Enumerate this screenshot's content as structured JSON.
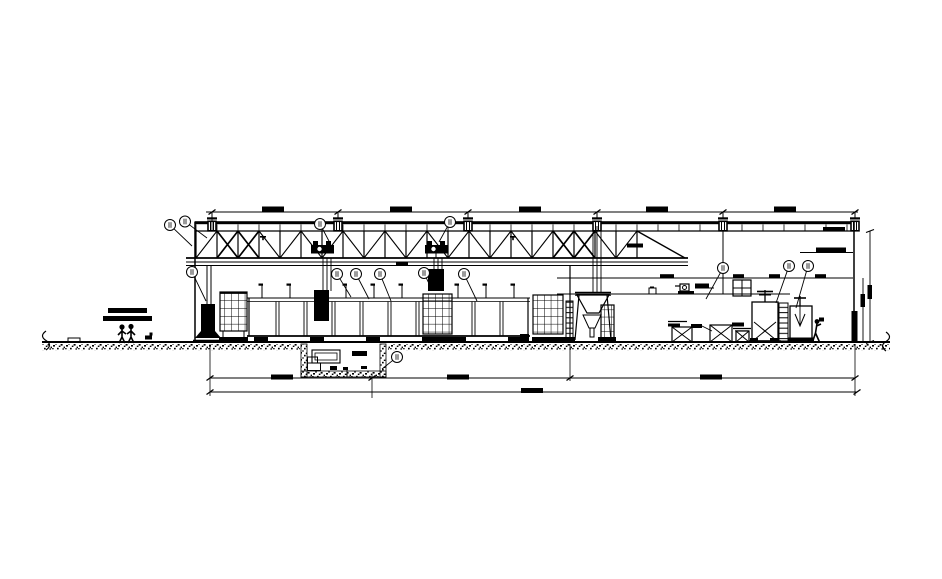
{
  "canvas": {
    "width": 942,
    "height": 579,
    "background": "#ffffff"
  },
  "drawing": {
    "description": "Black and white CAD section elevation of an industrial hall: suspended roof truss with hanger posts, hoist trolleys, process basin with grating panels, storage tank, furnace hopper with ladder, pump platform, crates, two agitated mixing tanks, workers, an underground pit and horizontal dimension chains",
    "ink": "#000000",
    "paper": "#ffffff",
    "callout_fill": "#ffffff",
    "callout_smudge": "#9a9a9a",
    "title": ""
  },
  "dimensions": {
    "top_chain": {
      "segments": 5,
      "texts": [
        "",
        "",
        "",
        "",
        ""
      ],
      "illegible": true
    },
    "bottom_chain_1": {
      "segments": 3,
      "texts": [
        "",
        "",
        ""
      ],
      "illegible": true
    },
    "bottom_chain_2": {
      "segments": 1,
      "texts": [
        ""
      ],
      "illegible": true
    },
    "right_vertical_chain": {
      "segments": 2,
      "texts": [
        "",
        ""
      ],
      "illegible": true
    },
    "interior_labels": {
      "count": 10,
      "texts_illegible": true
    }
  },
  "callouts": {
    "count": 14,
    "labels_illegible": true,
    "label_text": ""
  },
  "components": [
    "dimension-line-top",
    "roof-beam",
    "truss-top-chord",
    "roof-hangers",
    "roof-truss",
    "hoist-trolley-1",
    "hoist-trolley-2",
    "suspended-load",
    "left-wall",
    "right-wall",
    "storage-tank",
    "grating-panel-1",
    "process-basin",
    "grating-panel-2",
    "grating-panel-3",
    "furnace-hopper",
    "access-ladder",
    "annex-platform-lines",
    "pump-unit",
    "window-grid",
    "crate-1",
    "crate-2",
    "drum-crate",
    "mixing-tank-1",
    "tank-ladder",
    "mixing-tank-2",
    "worker-pair-left",
    "worker-right",
    "underground-pit",
    "ground-line",
    "ground-hatch",
    "break-mark-left",
    "break-mark-right",
    "dimension-line-bottom-1",
    "dimension-line-bottom-2",
    "door-opening"
  ]
}
